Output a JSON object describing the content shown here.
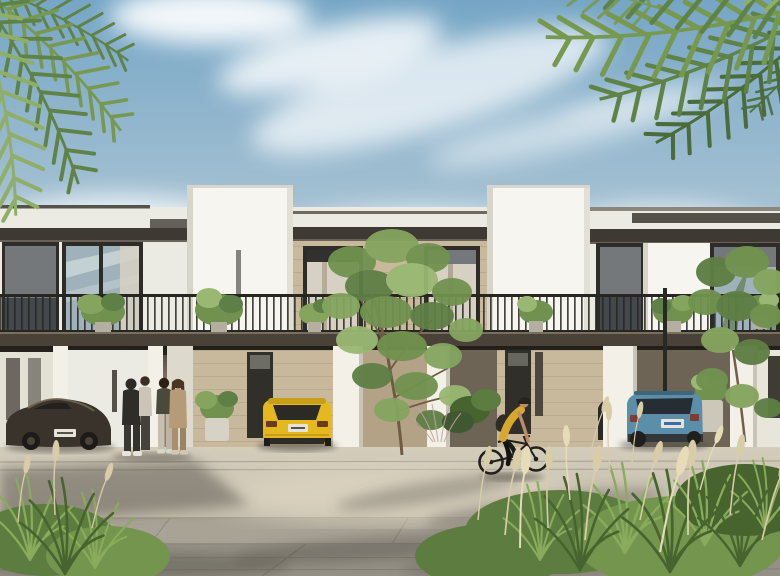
{
  "meta": {
    "title": "Architectural rendering: modern two-storey townhouse row with carports, palms, residents and parked cars",
    "scene_type": "photorealistic exterior render",
    "time_of_day": "daytime, sunny with wispy clouds"
  },
  "palette": {
    "sky-top": "#76a6c6",
    "sky-mid": "#a7c2d3",
    "sky-low": "#dbe5e9",
    "sky-horizon": "#eff1ef",
    "cloud": "#ffffff",
    "palm-dark": "#4a6b3a",
    "palm-mid": "#5f8347",
    "palm-light": "#77994f",
    "palm-pale": "#8fae68",
    "wall-white": "#ecebe3",
    "wall-bright": "#f6f5ef",
    "wall-shade": "#d7d4ca",
    "canopy": "#3e3a33",
    "roofline": "#55524a",
    "fascia": "#4a4238",
    "fascia-edge": "#78705f",
    "stone": "#c9b99c",
    "stone-dark": "#b3a286",
    "frame-dark": "#2e2c28",
    "glass-blue": "#9fb2bb",
    "glass-dark": "#42484c",
    "roller": "#75787a",
    "curtain": "#d7d1c3",
    "reflect-green": "#68815f",
    "railing": "#26251f",
    "soffit": "#413c34",
    "recess": "#8c8070",
    "recess-dark": "#6e6455",
    "pier": "#f2f0e7",
    "pier-shade": "#c8c4b7",
    "door": "#312f2a",
    "pave-light": "#d4cdbc",
    "pave-base": "#c3bcab",
    "pave-mid": "#a9a396",
    "pave-deep": "#959085",
    "joint": "#6f6b61",
    "shadow": "#55514a",
    "sun-patch": "#ded6c2",
    "grass-dark": "#47642f",
    "grass": "#5d7c3f",
    "grass-light": "#74954d",
    "leaf-bright": "#8aab5c",
    "plume": "#d8cda7",
    "plume-light": "#e6dcb8",
    "tree1": "#5e7f45",
    "tree2": "#71924f",
    "tree3": "#85a55f",
    "tree4": "#9ab873",
    "trunk": "#6f5b43",
    "car-dark": "#3a332b",
    "car-dark-hi": "#756a58",
    "car-yellow": "#e6b81f",
    "car-yellow-dark": "#c79e18",
    "suv": "#5b8ea9",
    "suv-dark": "#3e6579",
    "tint": "#262e34",
    "plate": "#e6e3d8",
    "plate-blue": "#3a6ab0",
    "skin": "#bb8d67",
    "cloth-dark": "#2f2d29",
    "cloth-light": "#cbc5b8",
    "cloth-tan": "#b59b78",
    "shirt-yellow": "#d7a72e",
    "helmet": "#26231f"
  },
  "scene": {
    "sky": {
      "label": "blue sky with cirrus clouds and bright haze near the rooftops"
    },
    "palms": {
      "label": "palm fronds overhanging top-left and top-right corners",
      "color": "#5f8347"
    },
    "buildings": {
      "label": "row of white modern townhouses, two storeys, flat parapet roofs",
      "towers": 2,
      "features": [
        "dark window canopies",
        "beige stone wall panels",
        "full-width black balcony railing",
        "potted balcony plants",
        "dark balcony fascia",
        "white carport piers",
        "recessed shaded ground floor",
        "dark entry doors"
      ]
    },
    "vehicles": [
      {
        "label": "dark brown sports coupe",
        "position": "far left carport",
        "color": "#3a332b"
      },
      {
        "label": "yellow hot-hatch, rear view",
        "position": "centre-left carport",
        "color": "#e6b81f"
      },
      {
        "label": "teal-blue compact SUV, rear view",
        "position": "right carport",
        "color": "#5b8ea9"
      }
    ],
    "people": {
      "label": "group of four residents chatting near left entrance",
      "count": 4
    },
    "cyclist": {
      "label": "woman in yellow top and black helmet riding a bicycle to the right"
    },
    "vegetation": {
      "center_tree": "airy green tree in front of the centre unit",
      "right_tree": "leafy tree in front of the right unit",
      "grasses": "ornamental fountain grass beds bottom-left and bottom-right",
      "planters": 2
    },
    "ground": {
      "label": "large-format pavers with palm-frond shadows"
    }
  }
}
